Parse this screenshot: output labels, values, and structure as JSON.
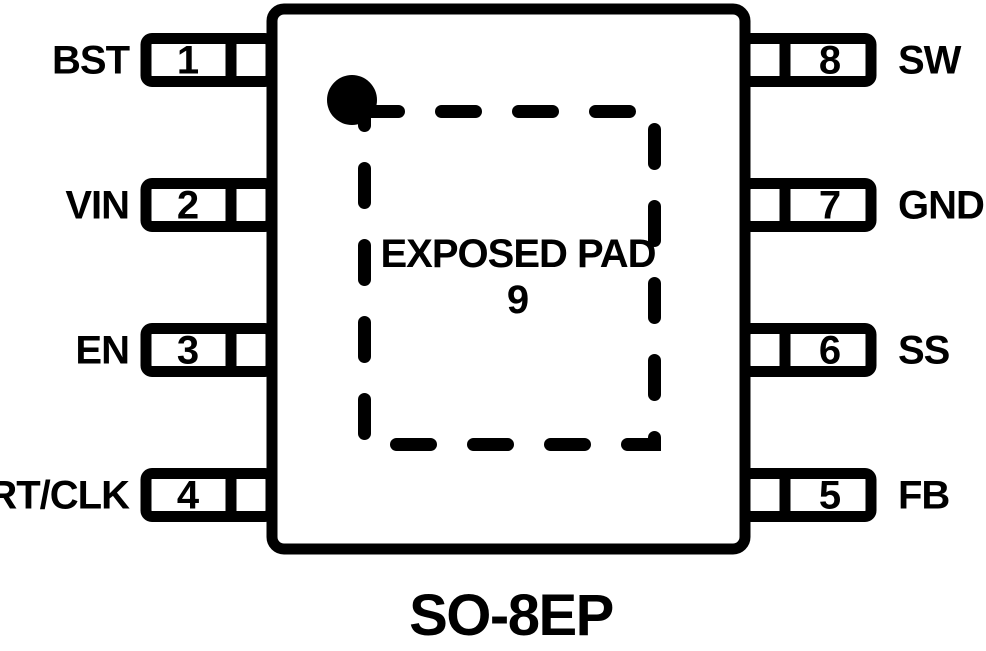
{
  "diagram": {
    "package": "SO-8EP",
    "exposed_pad": {
      "label": "EXPOSED PAD",
      "number": "9"
    },
    "pins": {
      "left": [
        {
          "number": "1",
          "label": "BST"
        },
        {
          "number": "2",
          "label": "VIN"
        },
        {
          "number": "3",
          "label": "EN"
        },
        {
          "number": "4",
          "label": "RT/CLK"
        }
      ],
      "right": [
        {
          "number": "8",
          "label": "SW"
        },
        {
          "number": "7",
          "label": "GND"
        },
        {
          "number": "6",
          "label": "SS"
        },
        {
          "number": "5",
          "label": "FB"
        }
      ]
    },
    "colors": {
      "ink": "#000000",
      "background": "#ffffff"
    }
  }
}
